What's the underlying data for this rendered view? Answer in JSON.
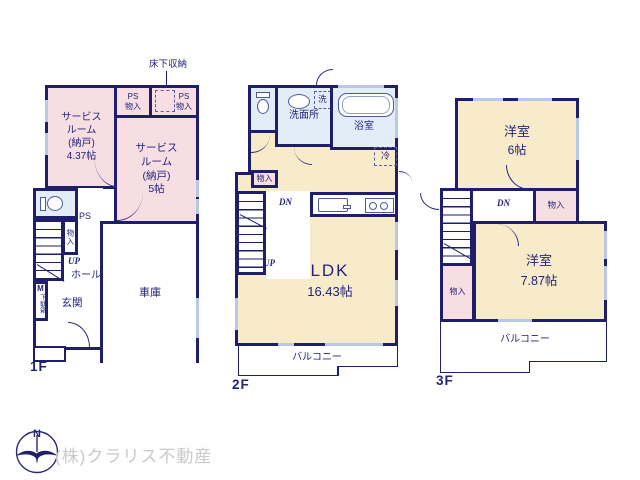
{
  "colors": {
    "wall": "#1e1e6b",
    "room_pink": "#f7dee2",
    "room_cream": "#f7ebc9",
    "room_blue": "#e3edf8",
    "window_glass": "#b9c8e6",
    "brand_gray": "#c9c9c9",
    "text_navy": "#23237a"
  },
  "f1": {
    "label": "1F",
    "floor_storage": "床下収納",
    "room_a": "サービス\nルーム\n(納戸)\n4.37帖",
    "ps_left": {
      "ps": "PS",
      "closet": "物入"
    },
    "ps_right": {
      "ps": "PS",
      "closet": "物入"
    },
    "room_b": "サービス\nルーム\n(納戸)\n5帖",
    "ps_small": "PS",
    "closet_vertical": "物入",
    "up": "UP",
    "hall": "ホール",
    "shoe_m": "M",
    "shoe_cabinet": "下駄箱",
    "entrance": "玄関",
    "garage": "車庫"
  },
  "f2": {
    "label": "2F",
    "washroom": "洗面所",
    "laundry": "洗",
    "bath": "浴室",
    "fridge": "冷",
    "closet": "物入",
    "dn": "DN",
    "up": "UP",
    "ldk": "LDK",
    "ldk_size": "16.43帖",
    "balcony": "バルコニー"
  },
  "f3": {
    "label": "3F",
    "room_upper": "洋室",
    "room_upper_size": "6帖",
    "dn": "DN",
    "closet_upper": "物入",
    "closet_lower": "物入",
    "room_lower": "洋室",
    "room_lower_size": "7.87帖",
    "balcony": "バルコニー"
  },
  "footer": {
    "north": "N",
    "brand": "(株)クラリス不動産"
  }
}
